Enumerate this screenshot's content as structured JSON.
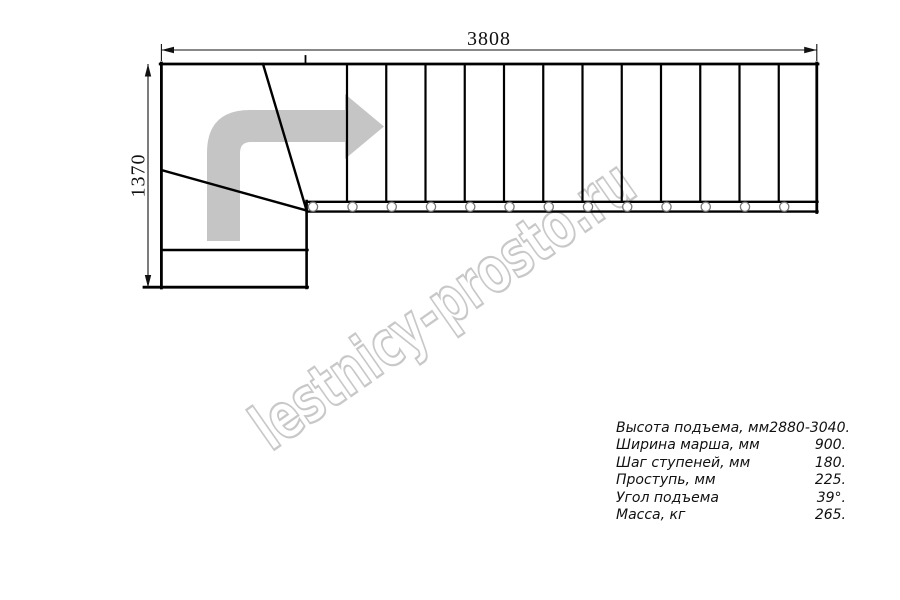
{
  "drawing": {
    "width_dimension": "3808",
    "height_dimension": "1370",
    "watermark_text": "lestnicy-prosto.ru"
  },
  "specs": {
    "rows": [
      {
        "label": "Высота подъема, мм",
        "value": "2880-3040."
      },
      {
        "label": "Ширина марша, мм",
        "value": "900."
      },
      {
        "label": "Шаг ступеней, мм",
        "value": "180."
      },
      {
        "label": "Проступь, мм",
        "value": "225."
      },
      {
        "label": "Угол подъема",
        "value": "39°."
      },
      {
        "label": "Масса, кг",
        "value": "265."
      }
    ]
  },
  "colors": {
    "line": "#000000",
    "dimension": "#111111",
    "arrow_fill": "#c5c5c5",
    "watermark_stroke": "#c8c8c8",
    "baluster_stroke": "#787878"
  }
}
